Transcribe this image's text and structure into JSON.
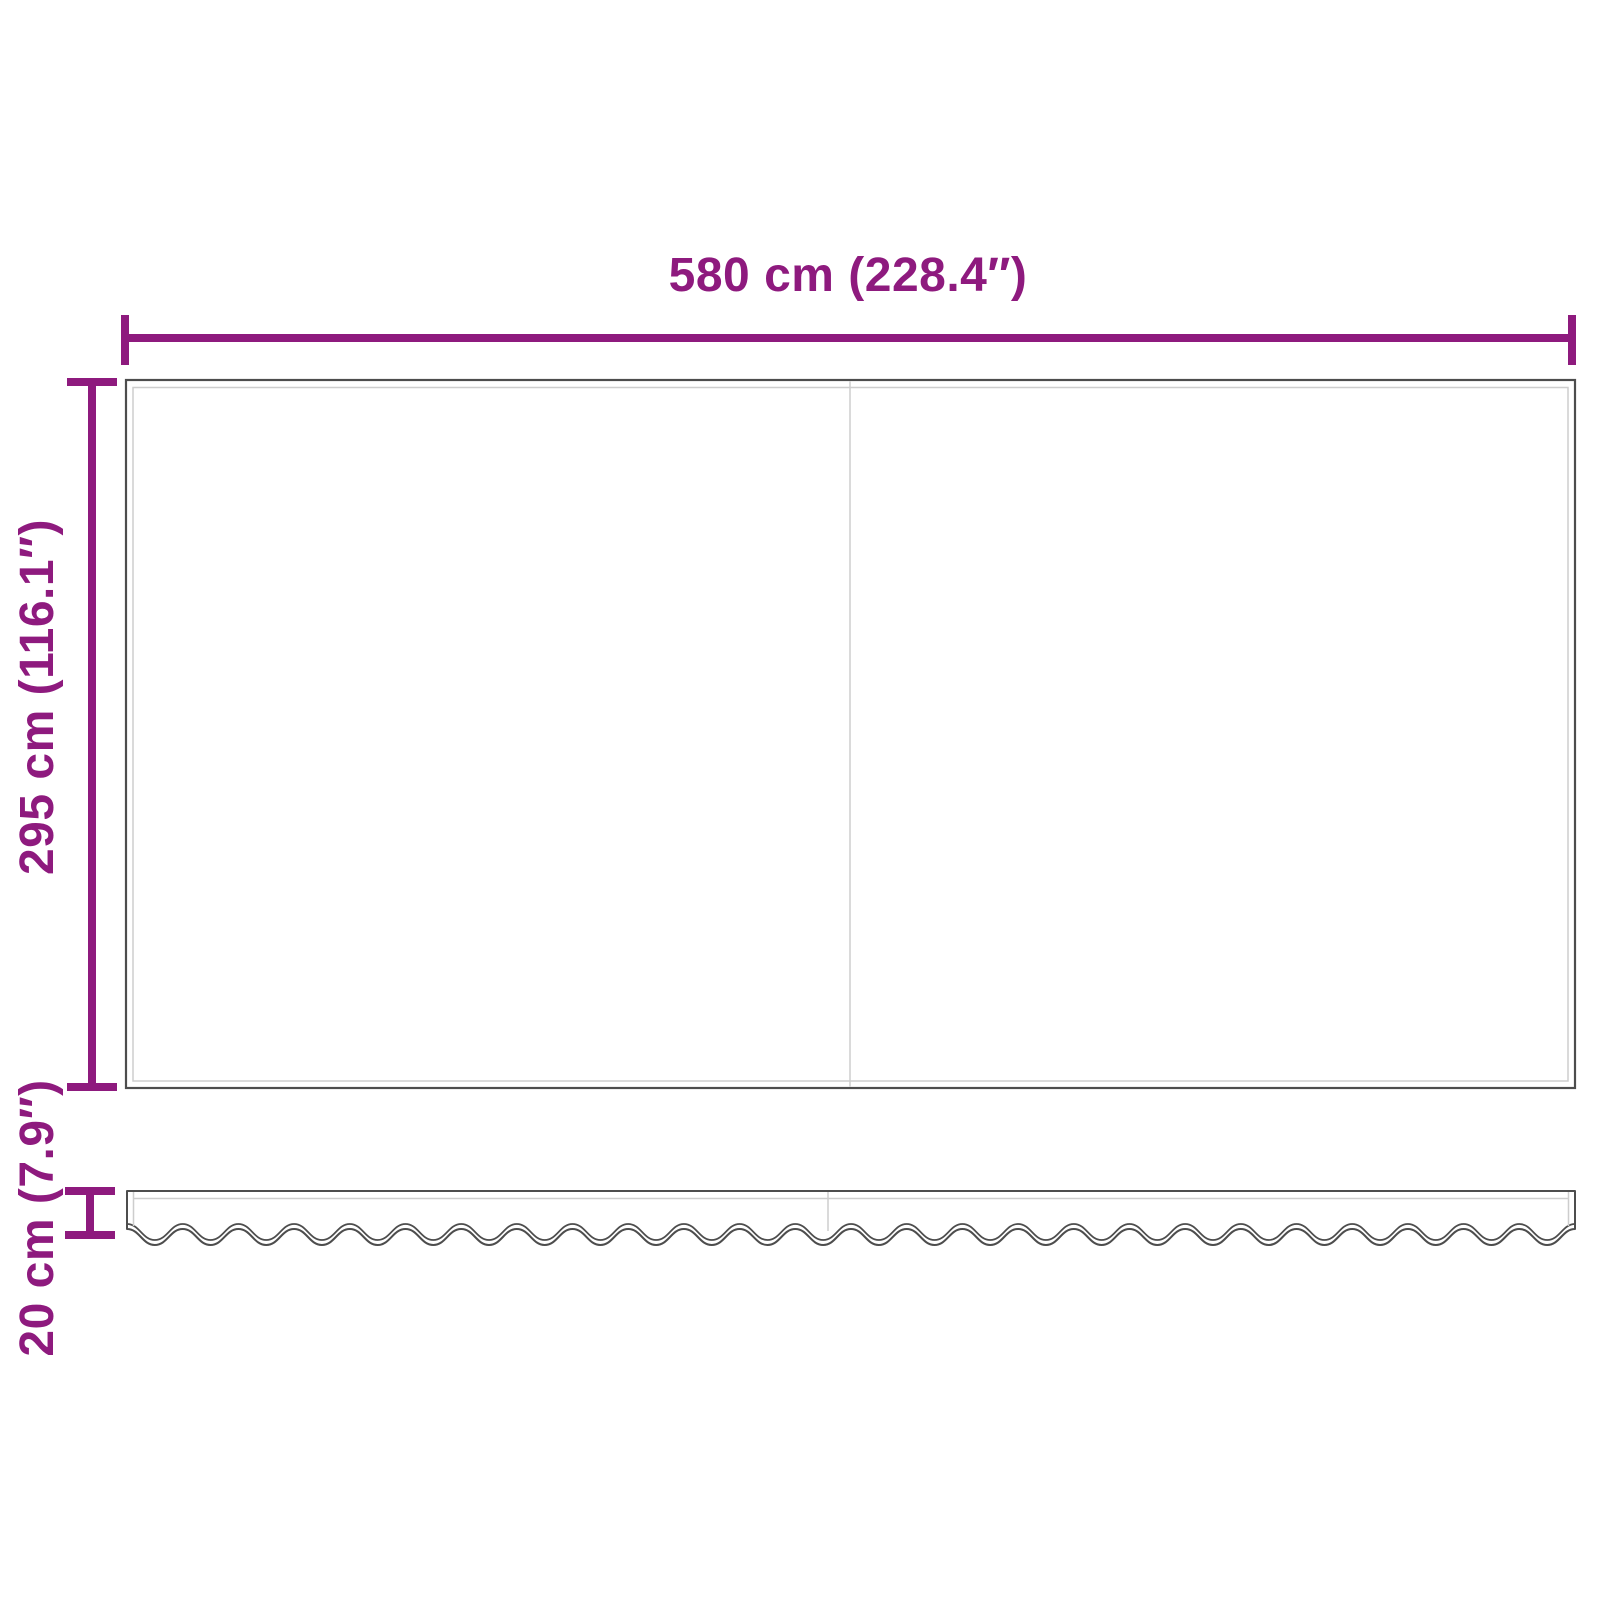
{
  "labels": {
    "width": "580 cm (228.4″)",
    "height": "295 cm (116.1″)",
    "valance_height": "20 cm (7.9″)"
  },
  "colors": {
    "dimension": "#8E1A7E",
    "outline": "#4D4D4D",
    "seam": "#CDCDCD",
    "background": "#FFFFFF"
  }
}
